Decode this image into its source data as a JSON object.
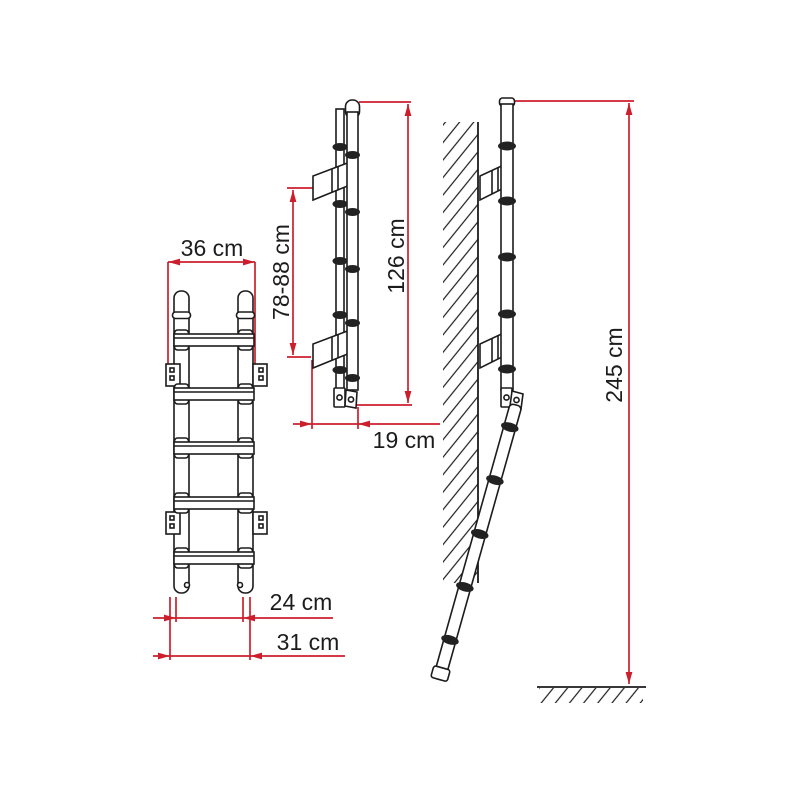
{
  "page": {
    "background": "#ffffff"
  },
  "drawing": {
    "title": "ladder technical drawing",
    "colors": {
      "dimension_red": "#cc1f2d",
      "line_black": "#1c1c1c"
    },
    "views": {
      "front": {
        "name": "front view (ladder closed)",
        "rung_count": 5,
        "dimensions": {
          "overall_width": "36 cm",
          "foot_width_inner": "24 cm",
          "foot_width_outer": "31 cm"
        }
      },
      "side": {
        "name": "side view (ladder folded)",
        "dimensions": {
          "bracket_distance": "78-88 cm",
          "folded_length": "126 cm",
          "wall_offset": "19 cm"
        }
      },
      "installed": {
        "name": "installed view (ladder open against wall)",
        "dimensions": {
          "overall_length": "245 cm"
        }
      }
    }
  }
}
